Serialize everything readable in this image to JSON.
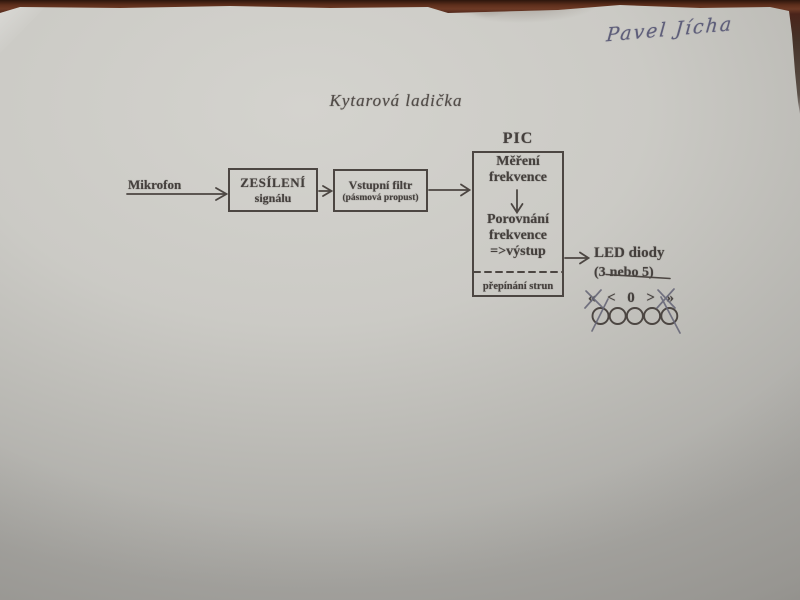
{
  "photo": {
    "handwritten_name": "Pavel Jícha"
  },
  "diagram": {
    "title": "Kytarová ladička",
    "microphone_label": "Mikrofon",
    "amplifier_box": {
      "line1": "ZESÍLENÍ",
      "line2": "signálu"
    },
    "filter_box": {
      "line1": "Vstupní filtr",
      "line2": "(pásmová propust)"
    },
    "pic_block": {
      "label": "PIC",
      "measure_line1": "Měření",
      "measure_line2": "frekvence",
      "compare_line1": "Porovnání",
      "compare_line2": "frekvence",
      "output_line": "=>výstup",
      "bottom_label": "přepínání strun"
    },
    "led_block": {
      "title": "LED diody",
      "count_prefix": "(3",
      "count_struck": "nebo 5)",
      "symbols": [
        "«",
        "<",
        "0",
        ">",
        "»"
      ],
      "circle_count": 5
    }
  },
  "colors": {
    "paper": "#cbcac5",
    "table_surface": "#5d2e1c",
    "printed_ink": "#45403d",
    "pen_ink": "#5d5d79"
  }
}
